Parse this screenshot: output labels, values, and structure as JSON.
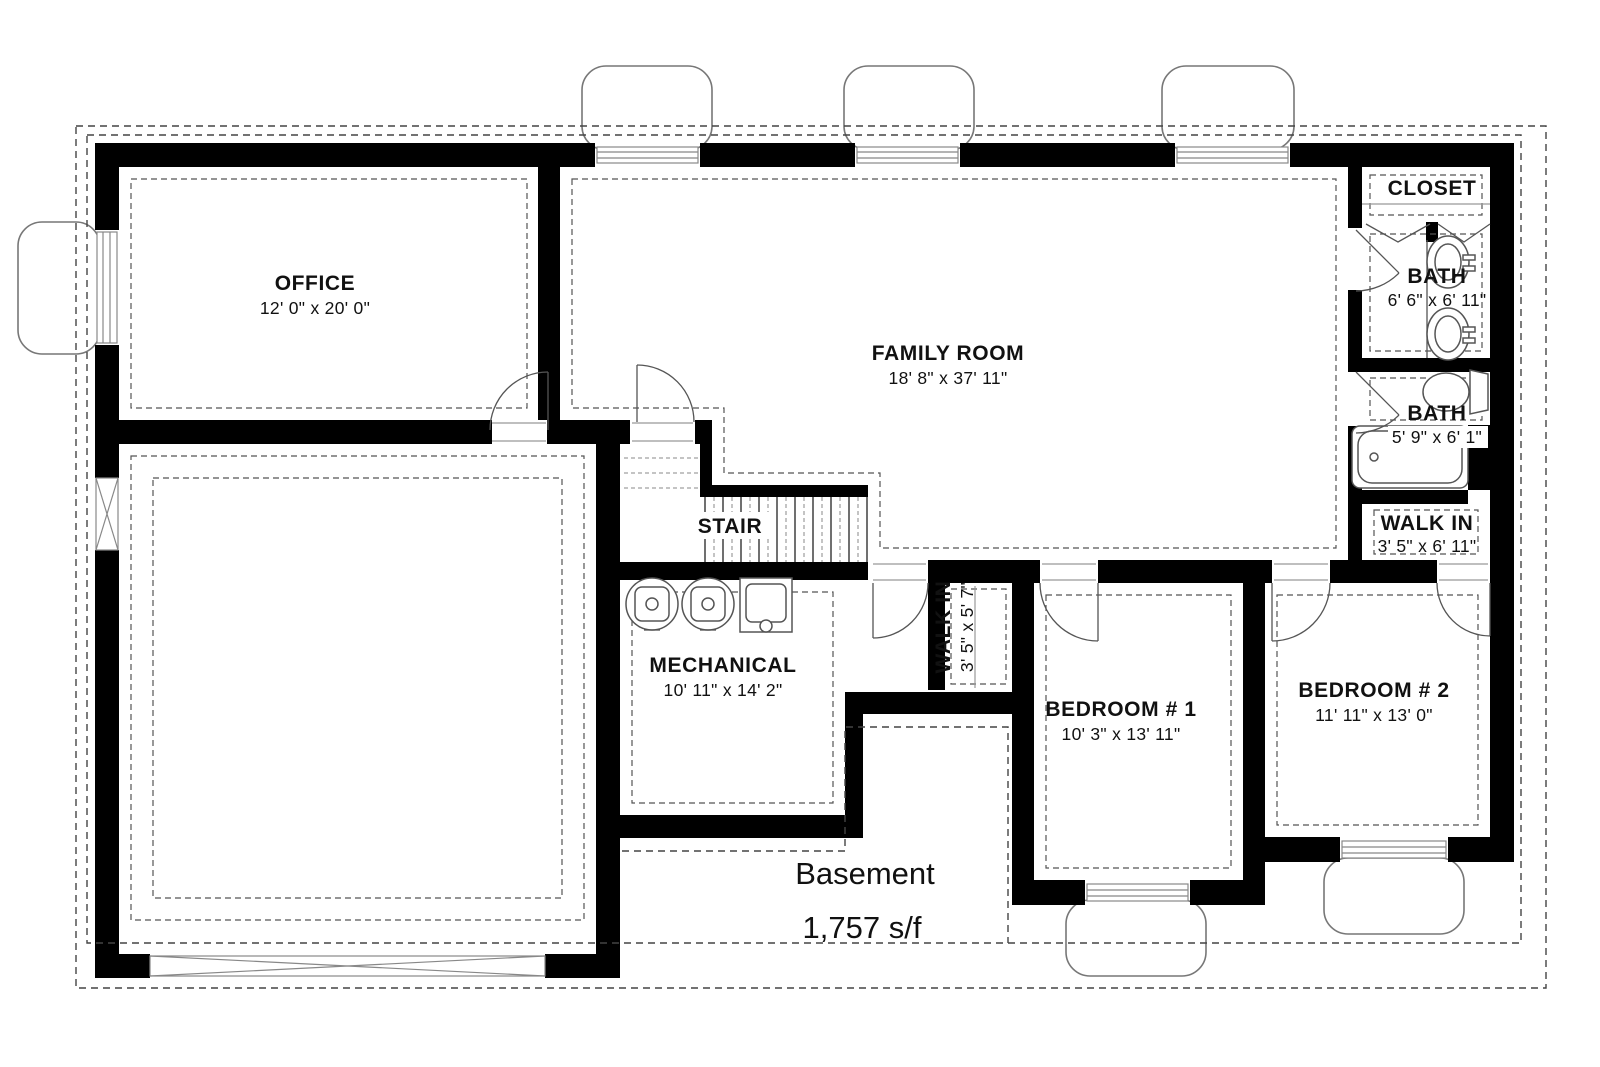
{
  "plan": {
    "title": "Basement",
    "area": "1,757 s/f",
    "rooms": [
      {
        "name": "OFFICE",
        "dims": "12' 0\" x 20' 0\""
      },
      {
        "name": "FAMILY ROOM",
        "dims": "18' 8\" x 37' 11\""
      },
      {
        "name": "CLOSET",
        "dims": ""
      },
      {
        "name": "BATH",
        "dims": "6' 6\" x 6' 11\""
      },
      {
        "name": "BATH",
        "dims": "5' 9\" x 6' 1\""
      },
      {
        "name": "WALK IN",
        "dims": "3' 5\" x 6' 11\""
      },
      {
        "name": "STAIR",
        "dims": ""
      },
      {
        "name": "MECHANICAL",
        "dims": "10' 11\" x 14' 2\""
      },
      {
        "name": "WALK IN",
        "dims": "3' 5\" x 5' 7\""
      },
      {
        "name": "BEDROOM # 1",
        "dims": "10' 3\" x 13' 11\""
      },
      {
        "name": "BEDROOM # 2",
        "dims": "11' 11\" x 13' 0\""
      }
    ],
    "colors": {
      "wall": "#000000",
      "background": "#ffffff",
      "dashed_line": "#444444",
      "fixture_line": "#555555"
    }
  }
}
